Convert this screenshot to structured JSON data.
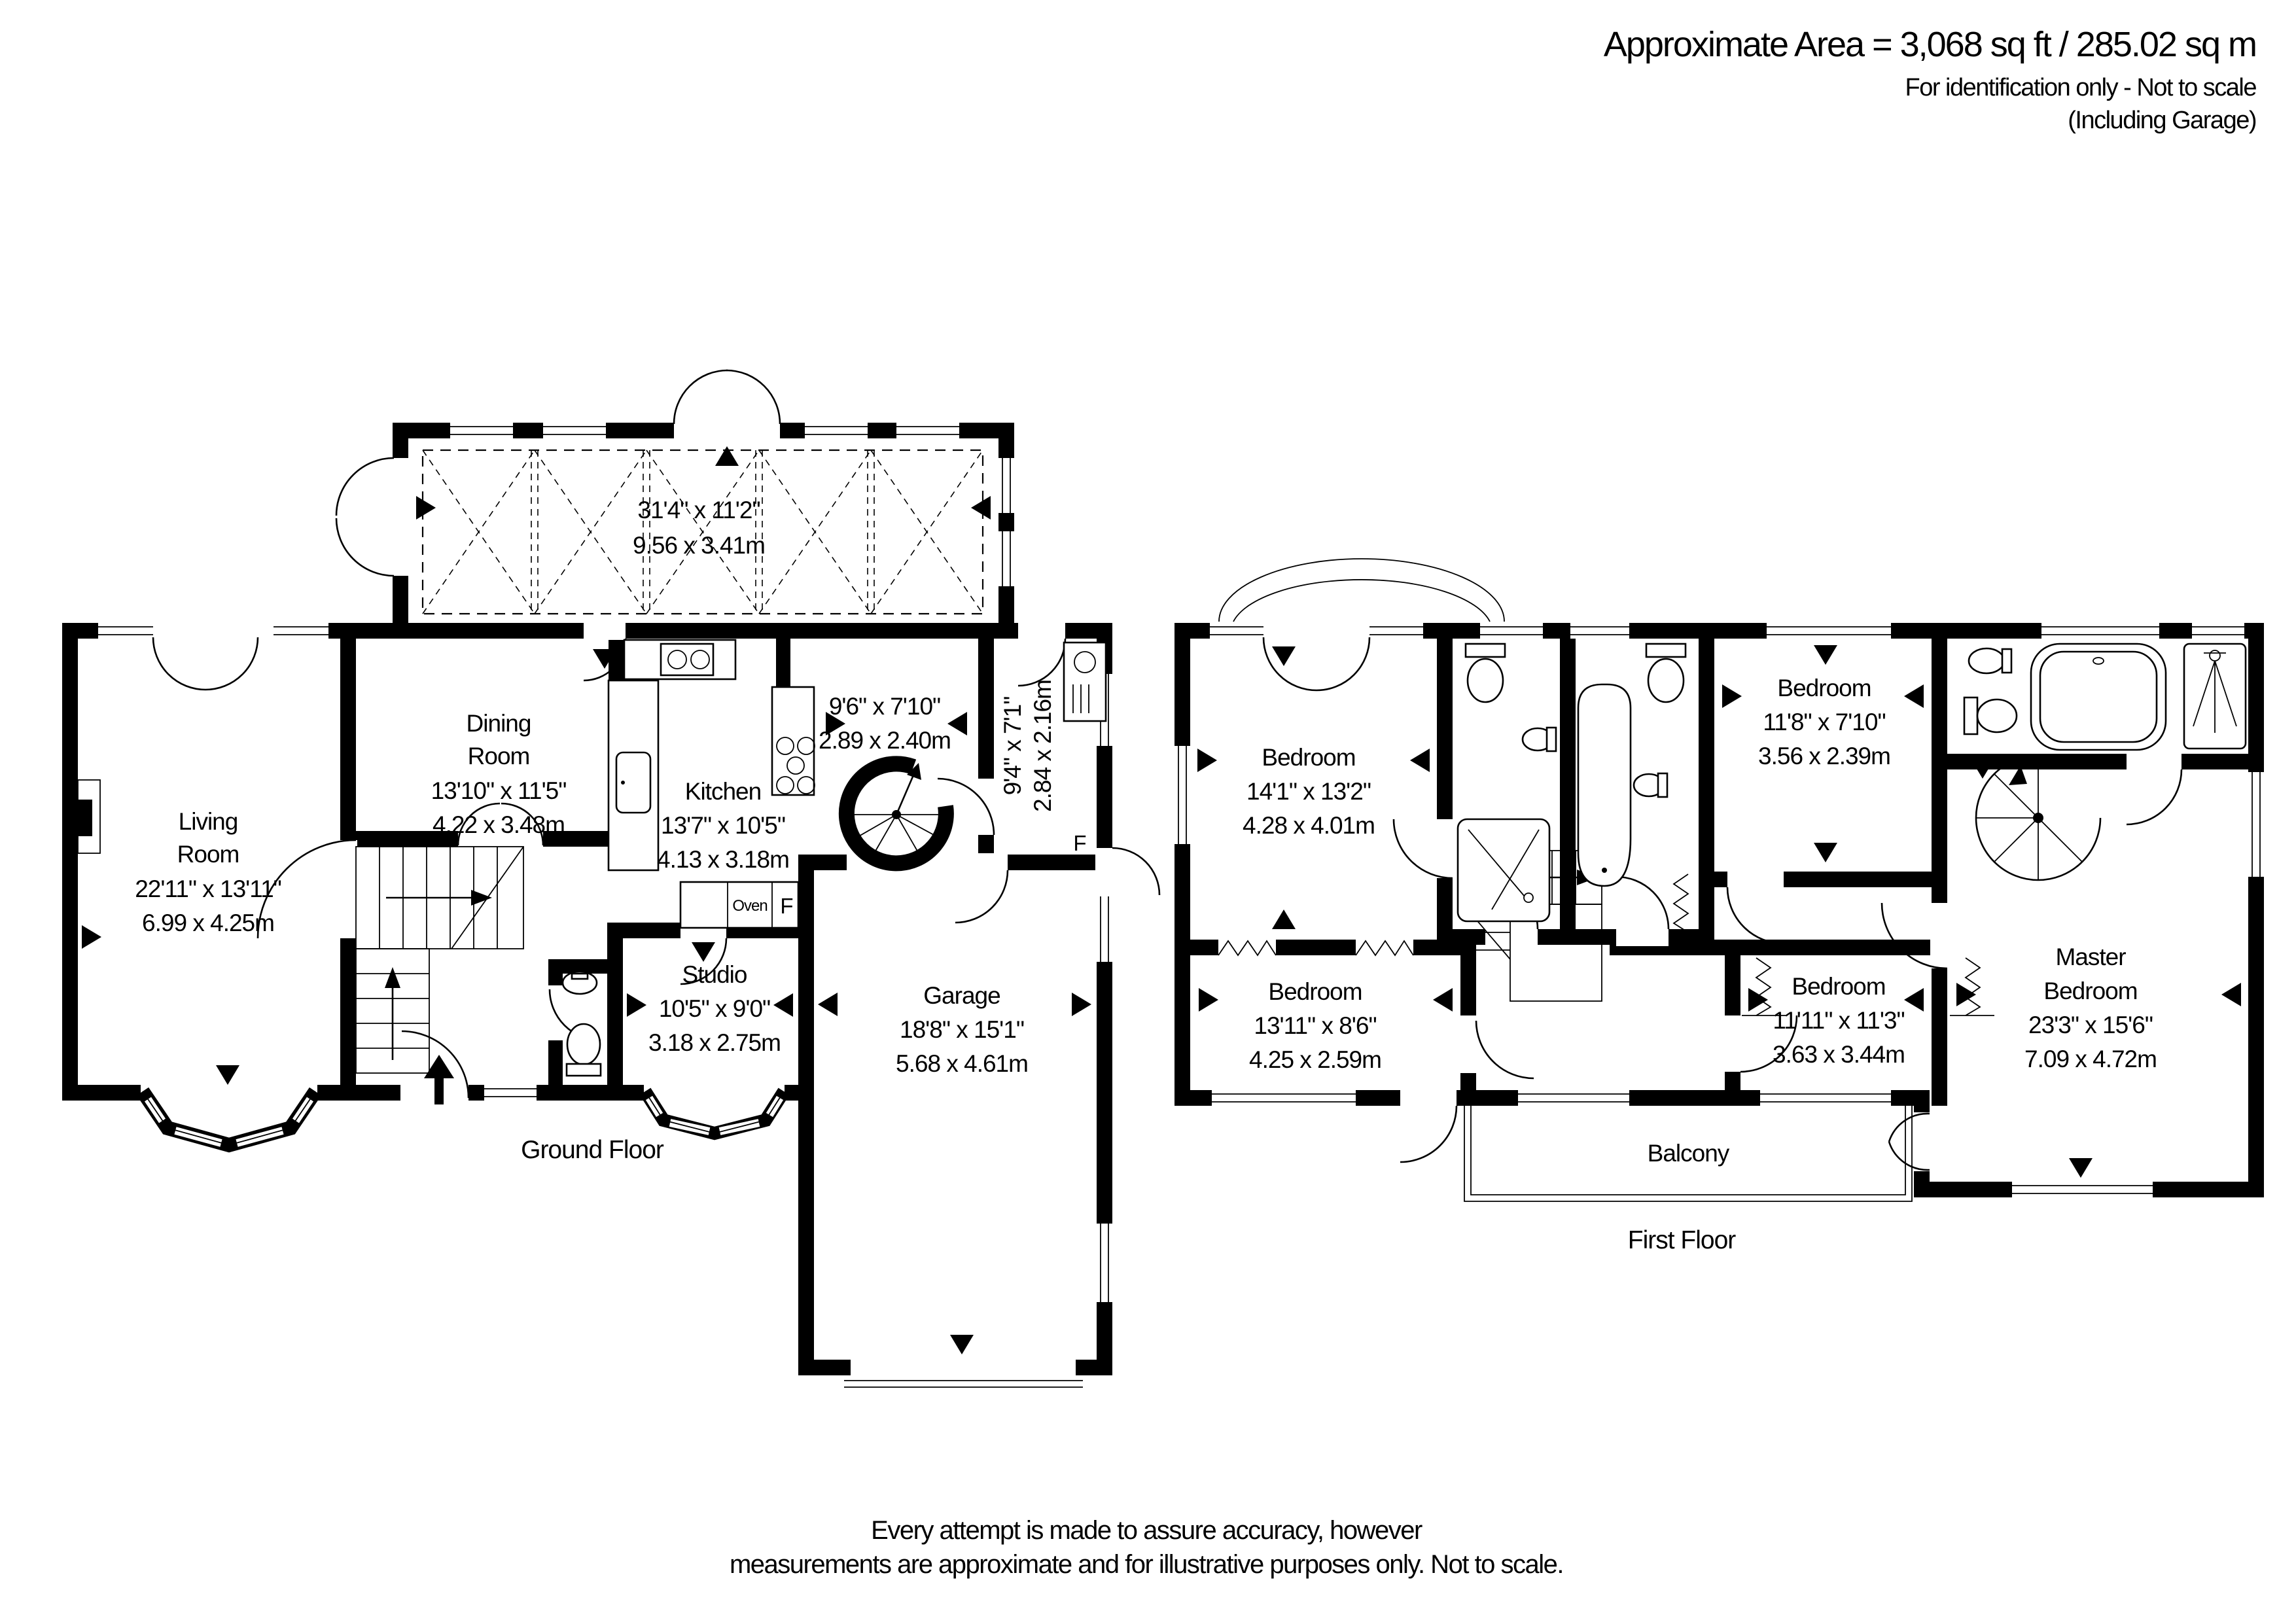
{
  "header": {
    "area": "Approximate Area = 3,068 sq ft / 285.02 sq m",
    "identification": "For identification only - Not to scale",
    "including": "(Including Garage)"
  },
  "ground_floor": {
    "label": "Ground Floor",
    "conservatory": {
      "ft": "31'4\" x 11'2\"",
      "m": "9.56 x 3.41m"
    },
    "living": {
      "name1": "Living",
      "name2": "Room",
      "ft": "22'11\" x 13'11\"",
      "m": "6.99 x 4.25m"
    },
    "dining": {
      "name1": "Dining",
      "name2": "Room",
      "ft": "13'10\" x 11'5\"",
      "m": "4.22 x 3.48m"
    },
    "kitchen": {
      "name": "Kitchen",
      "ft": "13'7\" x 10'5\"",
      "m": "4.13 x 3.18m"
    },
    "breakfast": {
      "ft": "9'6\" x 7'10\"",
      "m": "2.89 x 2.40m"
    },
    "utility": {
      "ft": "9'4\" x 7'1\"",
      "m": "2.84 x 2.16m"
    },
    "studio": {
      "name": "Studio",
      "ft": "10'5\" x 9'0\"",
      "m": "3.18 x 2.75m"
    },
    "garage": {
      "name": "Garage",
      "ft": "18'8\" x 15'1\"",
      "m": "5.68 x 4.61m"
    },
    "oven": "Oven",
    "fridge": "F",
    "utility_fridge": "F"
  },
  "first_floor": {
    "label": "First Floor",
    "balcony": "Balcony",
    "bedroom1": {
      "name": "Bedroom",
      "ft": "14'1\" x 13'2\"",
      "m": "4.28 x 4.01m"
    },
    "bedroom2": {
      "name": "Bedroom",
      "ft": "11'8\" x 7'10\"",
      "m": "3.56 x 2.39m"
    },
    "bedroom3": {
      "name": "Bedroom",
      "ft": "11'11\" x 11'3\"",
      "m": "3.63 x 3.44m"
    },
    "bedroom4": {
      "name": "Bedroom",
      "ft": "13'11\" x 8'6\"",
      "m": "4.25 x 2.59m"
    },
    "master": {
      "name1": "Master",
      "name2": "Bedroom",
      "ft": "23'3\" x 15'6\"",
      "m": "7.09 x 4.72m"
    }
  },
  "disclaimer": {
    "line1": "Every attempt is made to assure accuracy, however",
    "line2": "measurements are approximate and for illustrative purposes only. Not to scale."
  },
  "colors": {
    "ink": "#000000",
    "paper": "#ffffff"
  }
}
